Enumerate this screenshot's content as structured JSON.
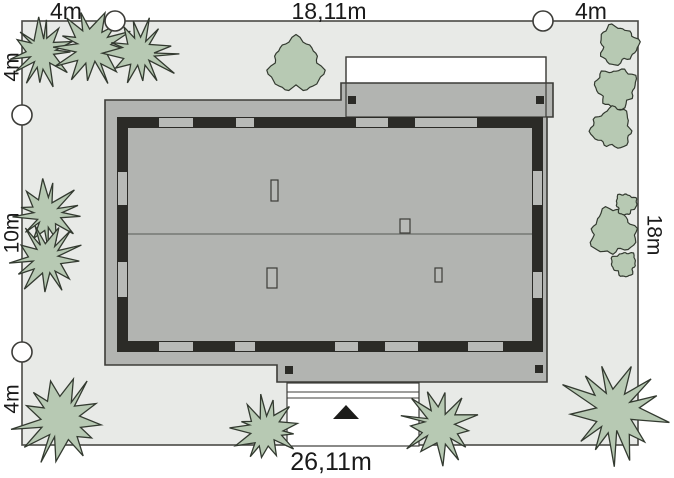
{
  "title": "house site plan",
  "dimensions": {
    "top": [
      "4m",
      "18,11m",
      "4m"
    ],
    "left": [
      "4m",
      "10m",
      "4m"
    ],
    "right": [
      "18m"
    ],
    "bottom": [
      "26,11m"
    ]
  },
  "colors": {
    "background": "#ffffff",
    "plot_fill": "#e8eae7",
    "plot_border": "#4a4a46",
    "roof_gray": "#b2b4b1",
    "window_gray": "#b8bab7",
    "wall_dark": "#2b2b27",
    "tree_fill": "#b7c9b3",
    "tree_stroke": "#333a30",
    "outline": "#3c3c38",
    "ridge": "#6a6c68",
    "marker_fill": "#ffffff",
    "entrance": "#1c1c1a",
    "label_text": "#1a1a1a"
  },
  "plan": {
    "plot": {
      "x": 22,
      "y": 21,
      "w": 616,
      "h": 424
    },
    "boundary_markers": {
      "r": 10,
      "centers": [
        [
          115,
          21
        ],
        [
          543,
          21
        ],
        [
          22,
          115
        ],
        [
          22,
          352
        ]
      ]
    },
    "house": {
      "roof_points": "105,100 341,100 341,83 553,83 553,117 547,117 547,382 277,382 277,365 105,365",
      "terrace": {
        "x": 346,
        "y": 57,
        "w": 200,
        "h": 60
      },
      "wall": {
        "x": 117,
        "y": 117,
        "w": 426,
        "h": 235,
        "t": 11
      },
      "windows": {
        "top": [
          [
            159,
            193
          ],
          [
            236,
            254
          ],
          [
            356,
            388
          ],
          [
            415,
            477
          ]
        ],
        "bottom": [
          [
            159,
            193
          ],
          [
            235,
            255
          ],
          [
            335,
            358
          ],
          [
            385,
            418
          ],
          [
            468,
            503
          ]
        ],
        "left": [
          [
            172,
            205
          ],
          [
            262,
            297
          ]
        ],
        "right": [
          [
            171,
            205
          ],
          [
            272,
            298
          ]
        ]
      },
      "ridge": {
        "y": 234,
        "x1": 128,
        "x2": 532
      },
      "roof_windows": [
        {
          "x": 271,
          "y": 180,
          "w": 7,
          "h": 21
        },
        {
          "x": 400,
          "y": 219,
          "w": 10,
          "h": 14
        },
        {
          "x": 267,
          "y": 268,
          "w": 10,
          "h": 20
        },
        {
          "x": 435,
          "y": 268,
          "w": 7,
          "h": 14
        }
      ],
      "chimneys": {
        "size": 8,
        "positions": [
          [
            348,
            96
          ],
          [
            536,
            96
          ],
          [
            285,
            366
          ],
          [
            535,
            365
          ]
        ]
      },
      "driveway": {
        "x": 287,
        "y": 383,
        "w": 132,
        "h": 63,
        "steps_y": [
          392,
          398
        ]
      },
      "entrance_triangle": "333,419 359,419 346,405"
    },
    "trees": {
      "spiky": [
        {
          "x": 42,
          "y": 52,
          "r": 36
        },
        {
          "x": 92,
          "y": 48,
          "r": 42
        },
        {
          "x": 140,
          "y": 52,
          "r": 40
        },
        {
          "x": 47,
          "y": 214,
          "r": 36
        },
        {
          "x": 46,
          "y": 258,
          "r": 38
        },
        {
          "x": 60,
          "y": 420,
          "r": 50
        },
        {
          "x": 266,
          "y": 430,
          "r": 36
        },
        {
          "x": 440,
          "y": 426,
          "r": 40
        },
        {
          "x": 614,
          "y": 412,
          "r": 58
        }
      ],
      "round": [
        {
          "x": 296,
          "y": 66,
          "r": 30
        },
        {
          "x": 618,
          "y": 45,
          "r": 22
        },
        {
          "x": 616,
          "y": 88,
          "r": 23
        },
        {
          "x": 612,
          "y": 128,
          "r": 23
        },
        {
          "x": 613,
          "y": 232,
          "r": 26
        },
        {
          "x": 626,
          "y": 204,
          "r": 12
        },
        {
          "x": 624,
          "y": 264,
          "r": 14
        }
      ]
    }
  }
}
